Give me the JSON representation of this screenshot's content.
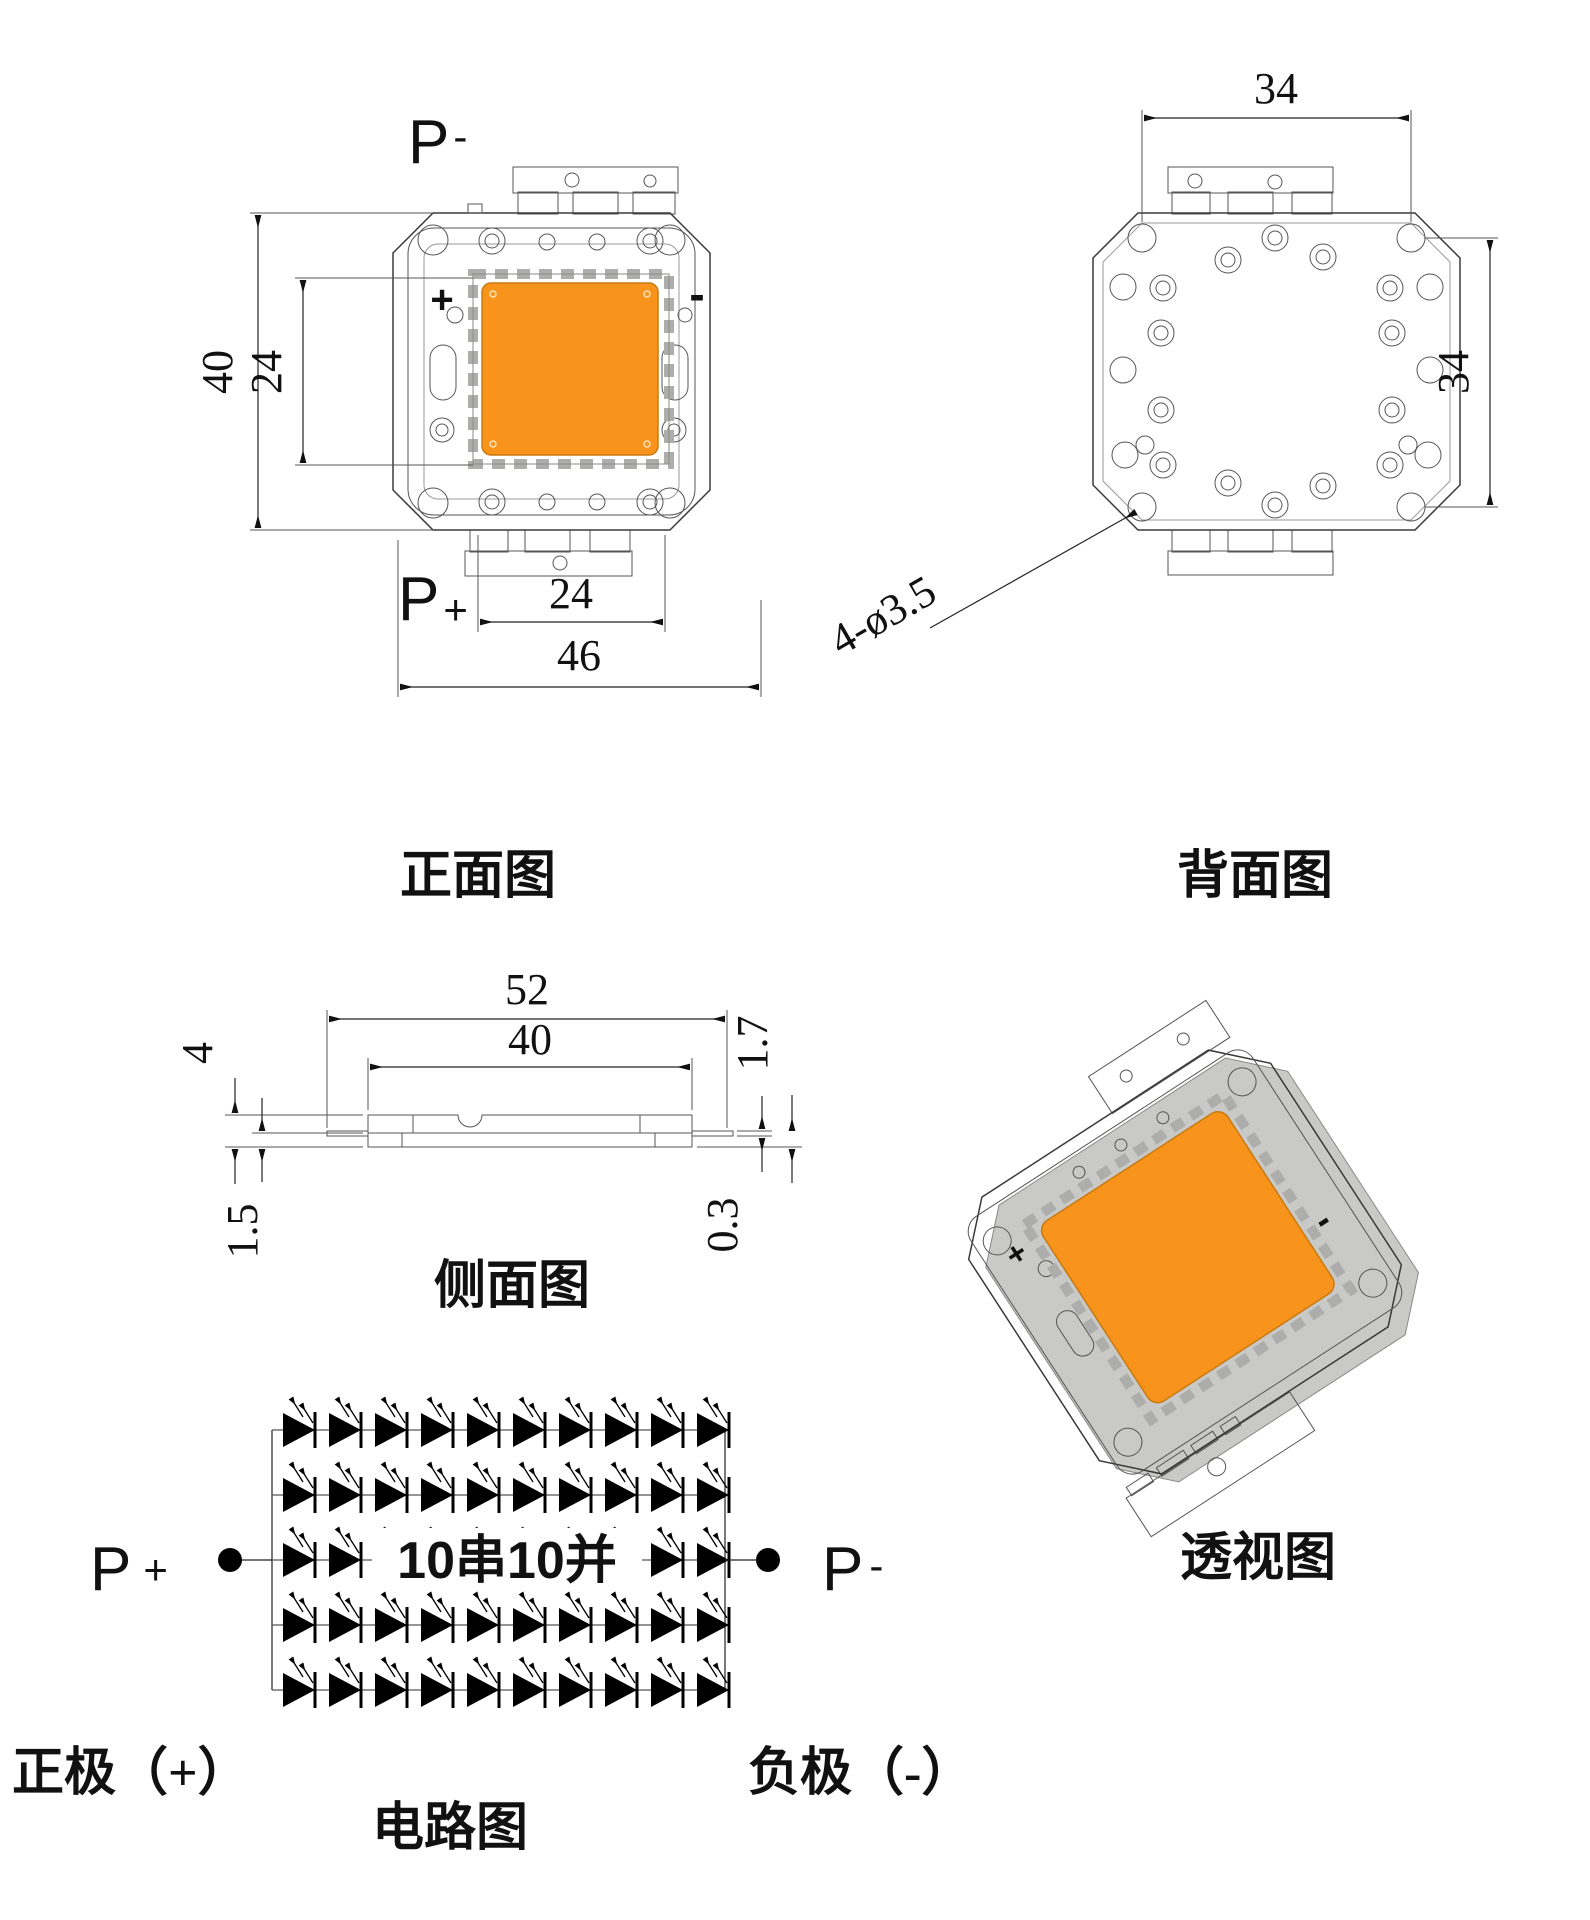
{
  "title": "LED module mechanical drawing",
  "colors": {
    "emitter_orange": "#F8941C",
    "plate_gray": "#ECECEA",
    "back_plate_gray": "#E3E3E1",
    "tab_gray": "#E4E4E2",
    "white_plate": "#FBFAF8",
    "teeth_gray": "#ADADAB",
    "line": "#3a3a3a"
  },
  "front": {
    "label": "正面图",
    "pad_top": {
      "letter": "P",
      "sign": "-"
    },
    "pad_bottom": {
      "letter": "P",
      "sign": "+"
    },
    "polarity_plus": "+",
    "polarity_minus": "-",
    "dim_height": "40",
    "dim_emitter": "24",
    "dim_tab": "24",
    "dim_width": "46"
  },
  "back": {
    "label": "背面图",
    "dim_width": "34",
    "dim_height": "34",
    "hole_note": "4-ø3.5"
  },
  "side": {
    "label": "侧面图",
    "dim_outer": "52",
    "dim_body": "40",
    "dim_total_height": "4",
    "dim_base": "1.5",
    "dim_right": "1.7",
    "dim_pin": "0.3"
  },
  "perspective": {
    "label": "透视图",
    "polarity_plus": "+",
    "polarity_minus": "-"
  },
  "circuit": {
    "label": "电路图",
    "config": "10串10并",
    "pos_terminal": {
      "letter": "P",
      "sign": "+"
    },
    "neg_terminal": {
      "letter": "P",
      "sign": "-"
    },
    "anode_label": "正极（+）",
    "cathode_label": "负极（-）",
    "rows": 5,
    "cols": 10
  }
}
